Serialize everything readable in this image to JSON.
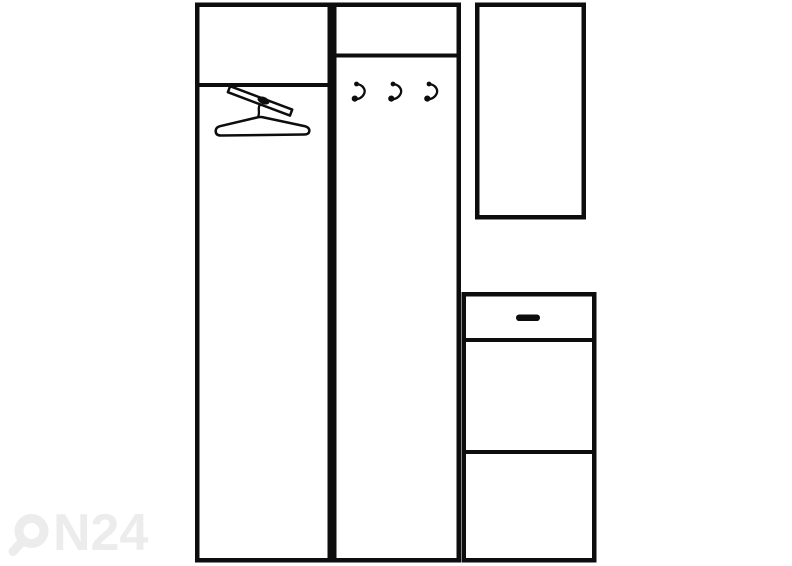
{
  "canvas": {
    "width": 792,
    "height": 566,
    "background": "#ffffff"
  },
  "illustration": {
    "description": "line-drawing-of-hallway-furniture-set",
    "line_color": "#0d0d0d",
    "components": [
      {
        "name": "wardrobe-with-hanger-rail",
        "sections": 2
      },
      {
        "name": "coat-hook-panel",
        "hook_count": 3
      },
      {
        "name": "mirror-panel",
        "sections": 1
      },
      {
        "name": "shoe-cabinet-with-drawer",
        "sections": 3,
        "handle_color": "#0d0d0d"
      }
    ]
  },
  "watermark": {
    "brand": "ON24",
    "logo_text": "N24",
    "color": "#ececec"
  }
}
